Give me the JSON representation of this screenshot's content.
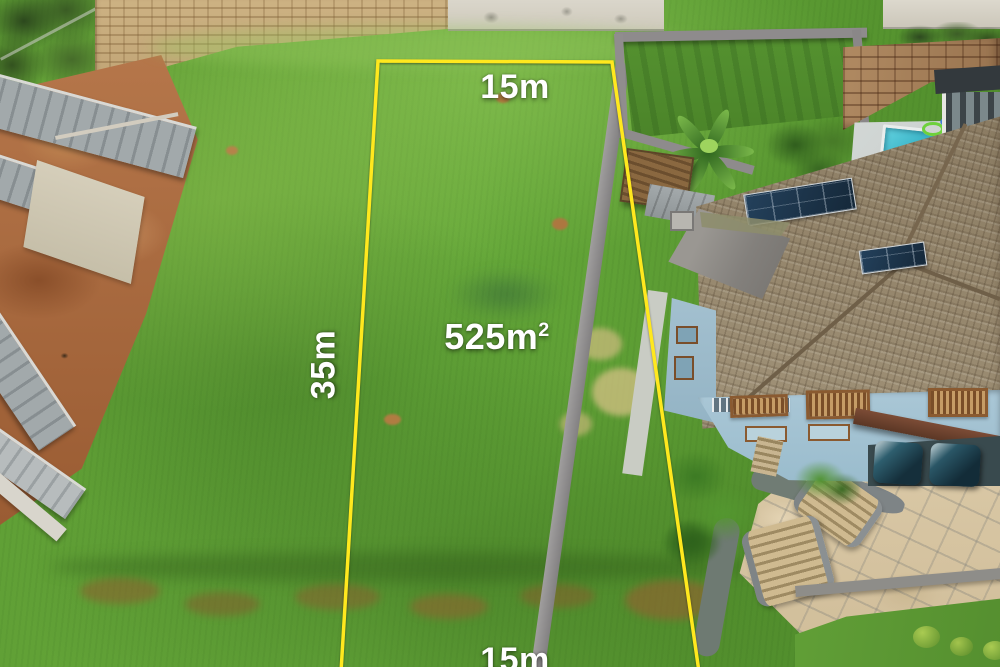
{
  "annotations": {
    "top_width": "15m",
    "side_length": "35m",
    "area": {
      "value": "525m",
      "superscript": "2"
    },
    "bottom_width": "15m"
  },
  "colors": {
    "boundary-yellow": "#ffe81e",
    "label-white": "#ffffff",
    "grass-green": "#5d9a33",
    "dirt-brown": "#a8693c",
    "pool-turquoise": "#35b5c9",
    "roof-tan": "#9b8c72",
    "house-blue": "#a5c3d3",
    "driveway-beige": "#d8c7a5"
  }
}
